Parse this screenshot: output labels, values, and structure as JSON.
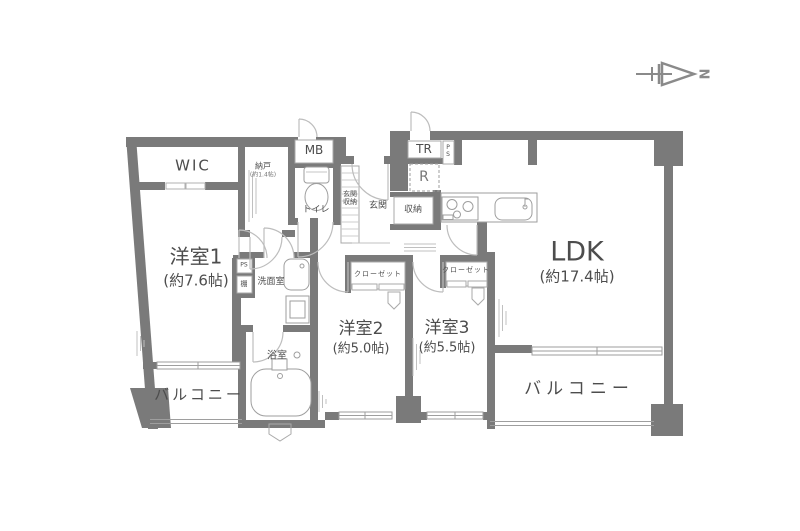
{
  "plan_title": "3LDK apartment floor plan",
  "colors": {
    "wall": "#7a7a7a",
    "fixture_line": "#9e9e9e",
    "door_arc": "#bdbdbd",
    "text": "#4d4d4d",
    "background": "#ffffff"
  },
  "compass": {
    "north_label": "N"
  },
  "rooms": {
    "wic": {
      "name": "WIC"
    },
    "storeroom": {
      "name": "納戸",
      "size": "(約1.4帖)"
    },
    "meter_box": {
      "name": "MB"
    },
    "toilet": {
      "name": "トイレ"
    },
    "entrance_storage": {
      "name": "玄関収納"
    },
    "entrance": {
      "name": "玄関"
    },
    "trunk_room": {
      "name": "TR"
    },
    "pipe_space_top": {
      "name": "PS"
    },
    "refrigerator_space": {
      "name": "R"
    },
    "hall_storage": {
      "name": "収納"
    },
    "western_room_1": {
      "name": "洋室1",
      "size": "(約7.6帖)"
    },
    "pipe_space_side": {
      "name": "PS"
    },
    "shelf": {
      "name": "棚"
    },
    "washroom": {
      "name": "洗面室"
    },
    "bathroom": {
      "name": "浴室"
    },
    "western_room_2": {
      "name": "洋室2",
      "size": "(約5.0帖)"
    },
    "western_room_3": {
      "name": "洋室3",
      "size": "(約5.5帖)"
    },
    "ldk": {
      "name": "LDK",
      "size": "(約17.4帖)"
    },
    "closet_w2": {
      "name": "クローゼット"
    },
    "closet_w3": {
      "name": "クローゼット"
    },
    "balcony_left": {
      "name": "バルコニー"
    },
    "balcony_right": {
      "name": "バルコニー"
    }
  }
}
